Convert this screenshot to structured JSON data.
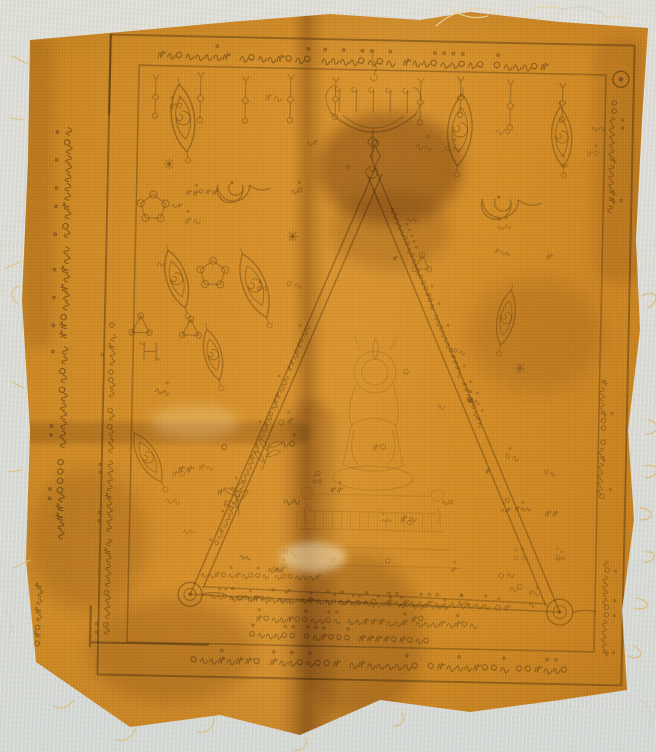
{
  "scene": {
    "type": "photograph",
    "subject": "Thai sacred yantra cloth (pha yant) hand-printed in dark ink on saffron-orange fabric, laid on a pale grey surface",
    "condition": "faded print, fold creases, brown stains, frayed cut edges"
  },
  "colors": {
    "background": "#dadad3",
    "cloth_base": "#d08a26",
    "cloth_shadowed": "#b8761c",
    "cloth_highlight": "#dd982f",
    "ink": "#553a10",
    "stain": "#6e4a12",
    "thread": "#dcbd83"
  },
  "cloth": {
    "top_border_text": "สพพเมตตา อเนกอานา มหาเมตตา ทุกาษปิติ อิกงาน",
    "bottom_border_text": "สพพเมตตา อเนกอานา มหาเมตตา ทุกาษปิติ อิกงาน",
    "left_margin_texts": [
      "วัดหัวป่า ตำบลบ้านขาว อำเภอระโนด จังหวัดสงขลา",
      "เมตตามหานิยม แคล้วคลาด กันภัย เจริญลาภ ๆ",
      "จิตตกาโม"
    ],
    "right_margin_texts": [
      "นะเมตตามหานิยม",
      "มหาลาโภ เจริญลาภ",
      "คงกระพันชาตรี"
    ],
    "triangle_script": "พุทธะสังมิ อิสวาสุ นะโมพุทธายะ นะมะพะทะ",
    "inner_script_lines": [
      "ลิตยิเวเนา ทิพมนตา",
      "อิติปิโส ภควา อรหัง สัมมาสัมพุทโธ",
      "นะโมพุทธายะ นะมะพะทะ จะภะกะสะ",
      "มะอะอุ อุอะมะ พุทโธนะโม"
    ],
    "scatter_glyphs": [
      "ๆ",
      "ฯ",
      "อุ",
      "นะ",
      "มะ",
      "พะ",
      "ทะ",
      "จะ",
      "ภะ",
      "กะ",
      "สะ",
      "ติ",
      "มิ",
      "อิ",
      "สัง",
      "วิ",
      "ธา",
      "ปุ",
      "ยะ",
      "๕",
      "๖",
      "๗",
      "๙"
    ],
    "motifs": [
      "candelabra-altar",
      "unalome-spiral",
      "hanging-tassel",
      "sacred-eye-oval",
      "om-coil",
      "pentagram-ring",
      "loop-triangle",
      "h-ligature",
      "leaf-sprig",
      "flower-asterisk",
      "buddha-in-triangle",
      "corner-spiral-loop",
      "circle-dot-seal"
    ]
  }
}
